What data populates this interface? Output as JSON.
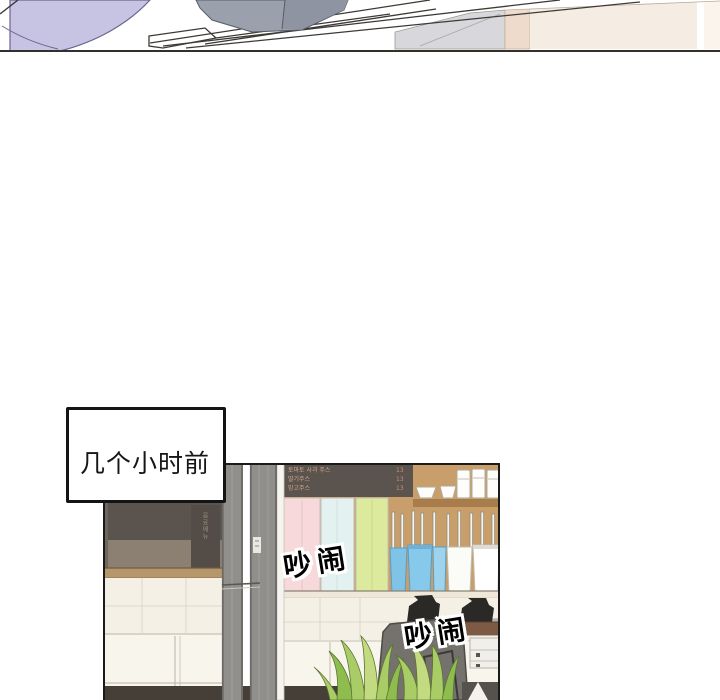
{
  "caption": {
    "text": "几个小时前"
  },
  "sfx": {
    "first": "吵闹",
    "second": "吵闹"
  },
  "menu_board": {
    "rows": [
      {
        "name": "토마토 사과 주스",
        "price": "13"
      },
      {
        "name": "딸기주스",
        "price": "13"
      },
      {
        "name": "망고주스",
        "price": "13"
      }
    ]
  },
  "side_board": {
    "vertical_text": "음료메뉴"
  },
  "colors": {
    "lavender": "#c6c3e3",
    "lavender-outline": "#6b6590",
    "gray-object": "#9ba0ad",
    "gray-object2": "#8f94a2",
    "beige-panel": "#f5ece3",
    "beige-panel-light": "#faf4ec",
    "pink-strip": "#eedbcc",
    "gray-glass": "#d8d8dc",
    "line-dark": "#3d3a36",
    "wall-taupe": "#8c8073",
    "board-dark": "#5b534e",
    "side-board": "#544d47",
    "wood": "#c89f6a",
    "wood-dark": "#a87c4b",
    "shelf-light": "#b5976b",
    "tile": "#f4f0e6",
    "tile-line": "#ddd7c9",
    "cabinet": "#f8f5ed",
    "cabinet-line": "#cfc9bb",
    "floor": "#463f37",
    "frame": "#918f8b",
    "frame-dark": "#6c6a66",
    "frame-mid": "#a09e9a",
    "pastel-pink": "#f7d9dc",
    "pastel-blue": "#e3f1f0",
    "pastel-green": "#dcea9e",
    "tumbler-blue": "#7fc4e6",
    "tumbler-blue2": "#9ed3ee",
    "tumbler-white": "#fbfbf8",
    "machine-gray": "#b5b2ac",
    "machine-dark": "#75726d",
    "counter-brown": "#7d5a44",
    "drawer-white": "#f1efe9",
    "plant": "#a9cc67",
    "plant-dark": "#8fbc4e",
    "plant-light": "#c3da80"
  }
}
